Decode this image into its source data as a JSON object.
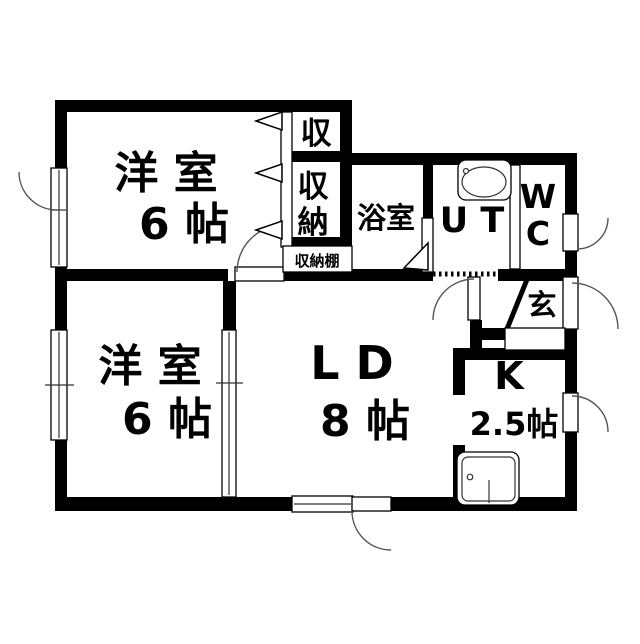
{
  "plan_title": "2LDK floor plan",
  "colors": {
    "wall": "#000000",
    "floor": "#ffffff",
    "line": "#555555"
  },
  "rooms": {
    "bedroom_top": {
      "name": "洋 室",
      "size": "6 帖"
    },
    "bedroom_bottom": {
      "name": "洋 室",
      "size": "6 帖"
    },
    "living_dining": {
      "name": "L D",
      "size": "8 帖"
    },
    "kitchen": {
      "name": "K",
      "size": "2.5帖"
    },
    "bathroom": {
      "name": "浴室"
    },
    "utility": {
      "name": "U T"
    },
    "toilet": {
      "line1": "W",
      "line2": "C"
    },
    "entrance": {
      "name": "玄"
    },
    "storage_top": {
      "name": "収"
    },
    "closet": {
      "line1": "収",
      "line2": "納"
    },
    "storage_shelf": {
      "name": "収納棚"
    }
  }
}
